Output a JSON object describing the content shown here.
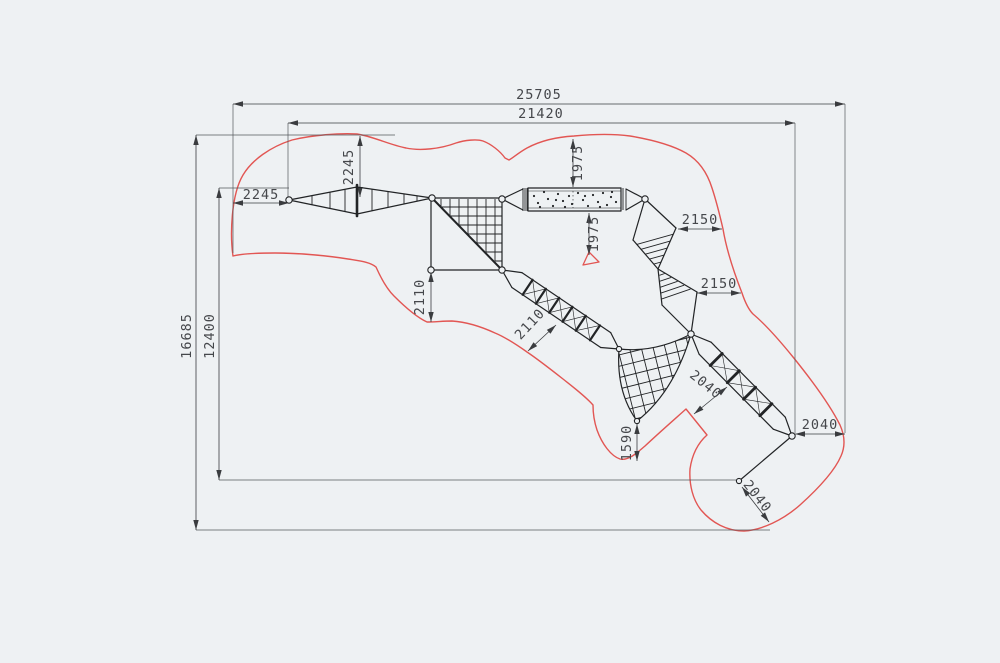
{
  "drawing_type": "playground-rope-course-plan-with-safety-zone",
  "dimensions": {
    "safety_zone_width": "25705",
    "structure_width": "21420",
    "safety_zone_height": "16685",
    "structure_height": "12400",
    "left_clearance": "2245",
    "top_clearance": "2245",
    "bridge_top_clearance": "1975",
    "bridge_bottom_clearance": "1975",
    "upper_right_clearance": "2150",
    "lower_right_clearance": "2150",
    "mid_clearance_vertical": "2110",
    "mid_clearance_diagonal": "2110",
    "ladder_clearance_diagonal": "2040",
    "right_clearance": "2040",
    "bottom_clearance_diagonal": "2040",
    "bottom_net_clearance": "1590"
  },
  "colors": {
    "background": "#eef1f3",
    "structure_line": "#222426",
    "dimension_line": "#3a3c3f",
    "dimension_text": "#45474b",
    "safety_zone": "#e25653"
  }
}
